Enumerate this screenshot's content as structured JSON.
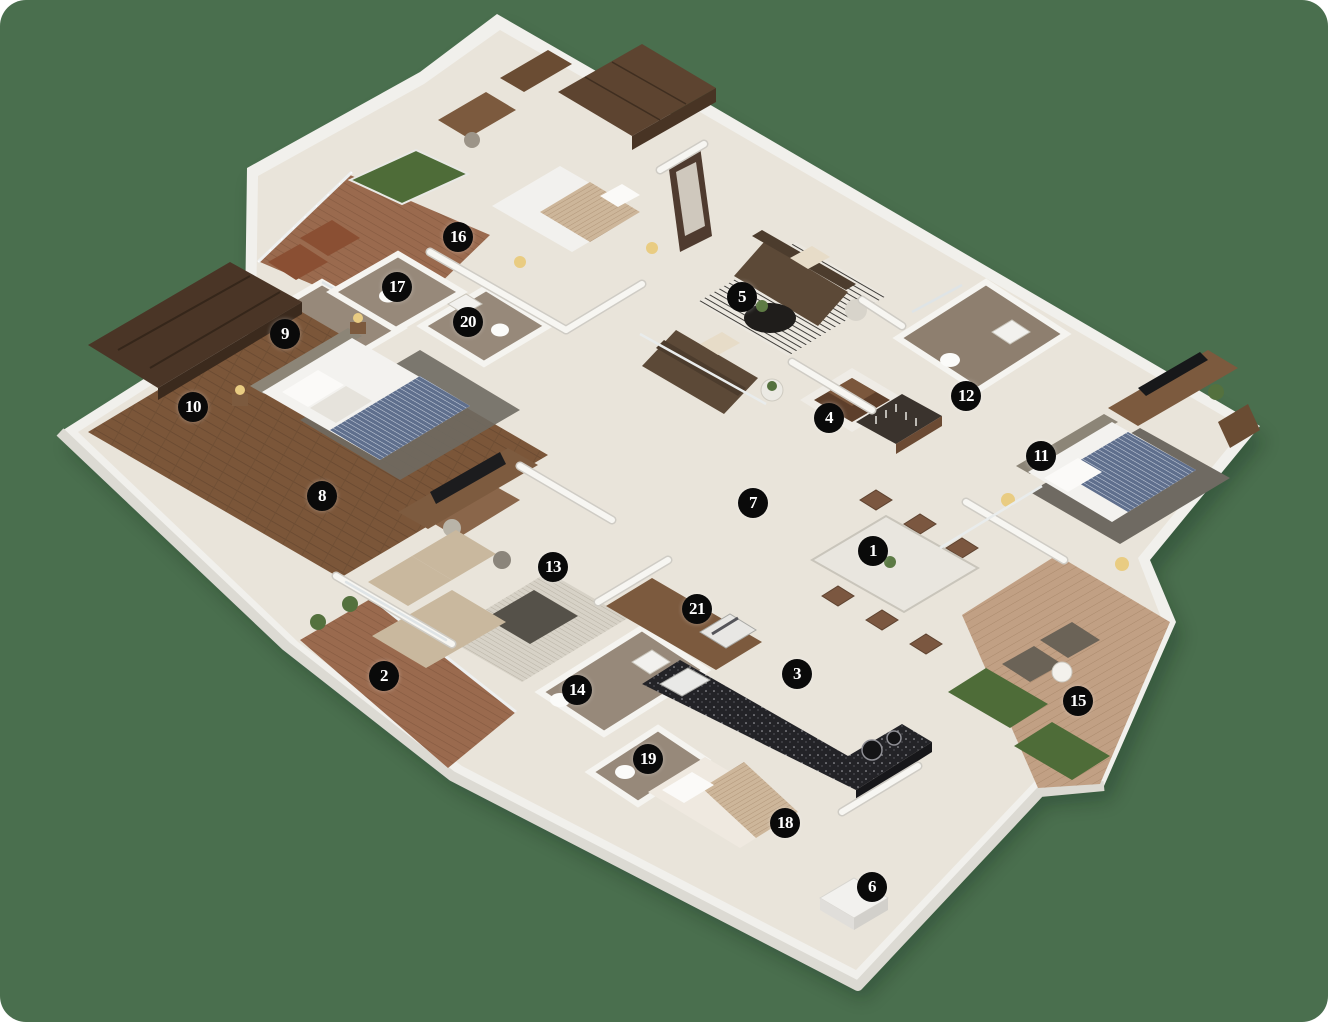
{
  "image": {
    "type": "3d-isometric-floor-plan",
    "background_color": "#4a6f4e",
    "marker_color": "#0a0a0a",
    "marker_text_color": "#ffffff"
  },
  "markers": [
    {
      "label": "1",
      "x": 873,
      "y": 551
    },
    {
      "label": "2",
      "x": 384,
      "y": 676
    },
    {
      "label": "3",
      "x": 797,
      "y": 674
    },
    {
      "label": "4",
      "x": 829,
      "y": 418
    },
    {
      "label": "5",
      "x": 742,
      "y": 297
    },
    {
      "label": "6",
      "x": 872,
      "y": 887
    },
    {
      "label": "7",
      "x": 753,
      "y": 503
    },
    {
      "label": "8",
      "x": 322,
      "y": 496
    },
    {
      "label": "9",
      "x": 285,
      "y": 334
    },
    {
      "label": "10",
      "x": 193,
      "y": 407
    },
    {
      "label": "11",
      "x": 1041,
      "y": 456
    },
    {
      "label": "12",
      "x": 966,
      "y": 396
    },
    {
      "label": "13",
      "x": 553,
      "y": 567
    },
    {
      "label": "14",
      "x": 577,
      "y": 690
    },
    {
      "label": "15",
      "x": 1078,
      "y": 701
    },
    {
      "label": "16",
      "x": 458,
      "y": 237
    },
    {
      "label": "17",
      "x": 397,
      "y": 287
    },
    {
      "label": "18",
      "x": 785,
      "y": 823
    },
    {
      "label": "19",
      "x": 648,
      "y": 759
    },
    {
      "label": "20",
      "x": 468,
      "y": 322
    },
    {
      "label": "21",
      "x": 697,
      "y": 609
    }
  ]
}
